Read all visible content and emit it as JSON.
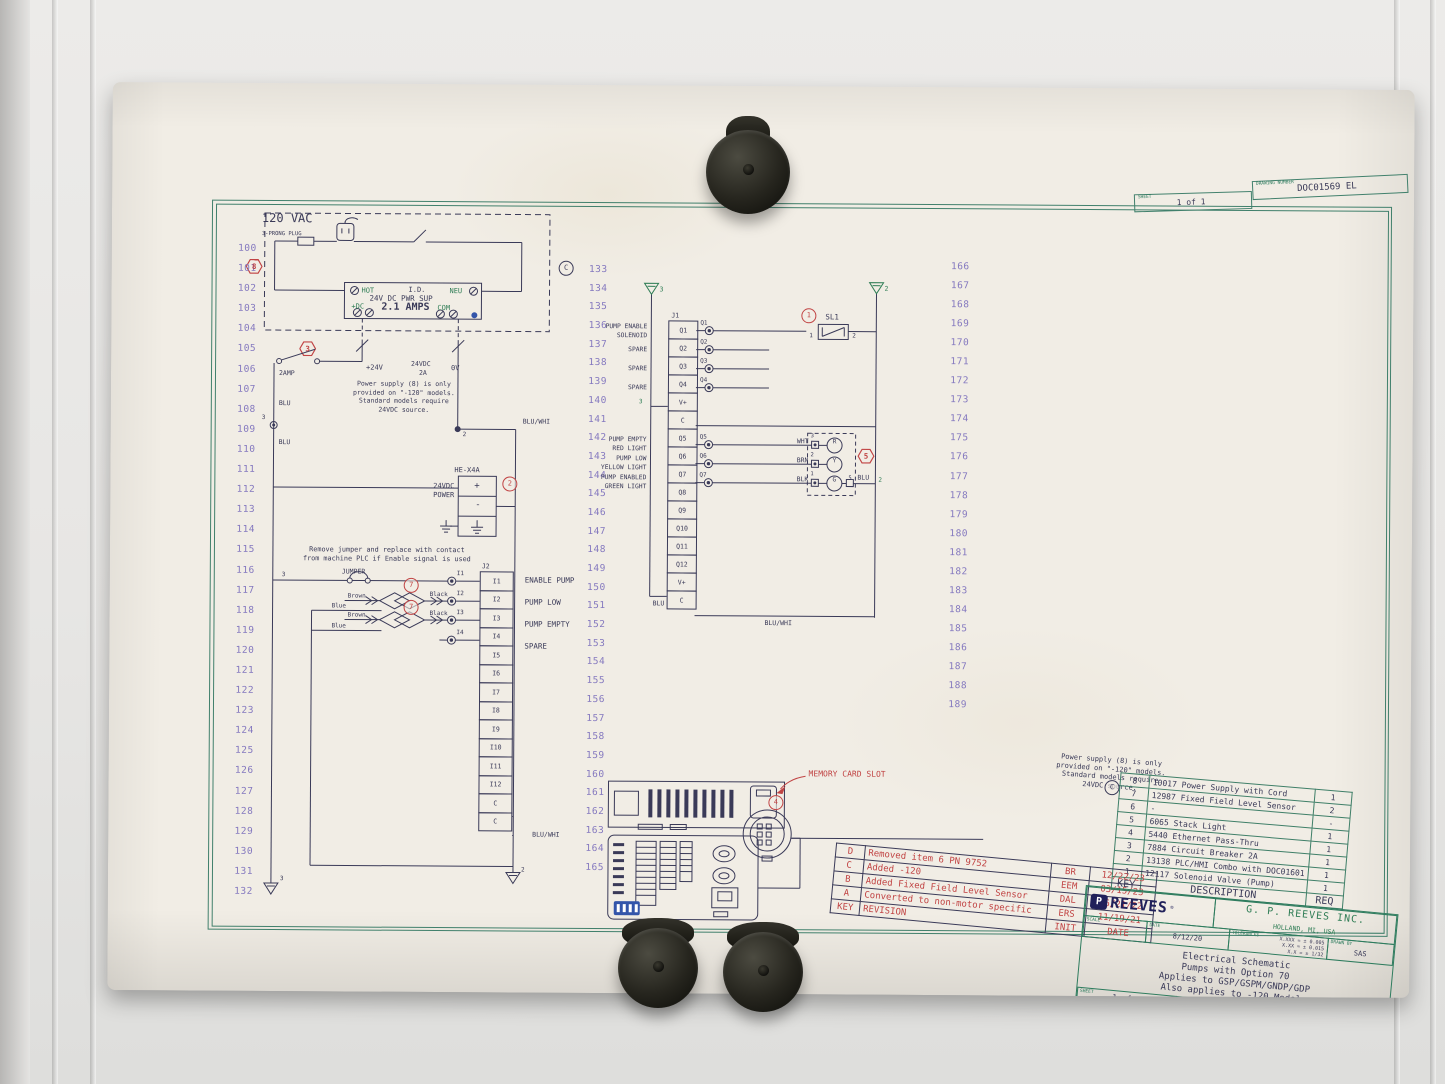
{
  "frame": {
    "sheet_label": "SHEET",
    "sheet_value": "1 of 1",
    "dwg_label": "DRAWING NUMBER",
    "dwg_value": "DOC01569 EL"
  },
  "wires": {
    "left": [
      "100",
      "101",
      "102",
      "103",
      "104",
      "105",
      "106",
      "107",
      "108",
      "109",
      "110",
      "111",
      "112",
      "113",
      "114",
      "115",
      "116",
      "117",
      "118",
      "119",
      "120",
      "121",
      "122",
      "123",
      "124",
      "125",
      "126",
      "127",
      "128",
      "129",
      "130",
      "131",
      "132"
    ],
    "middle": [
      "133",
      "134",
      "135",
      "136",
      "137",
      "138",
      "139",
      "140",
      "141",
      "142",
      "143",
      "144",
      "145",
      "146",
      "147",
      "148",
      "149",
      "150",
      "151",
      "152",
      "153",
      "154",
      "155",
      "156",
      "157",
      "158",
      "159",
      "160",
      "161",
      "162",
      "163",
      "164",
      "165"
    ],
    "right": [
      "166",
      "167",
      "168",
      "169",
      "170",
      "171",
      "172",
      "173",
      "174",
      "175",
      "176",
      "177",
      "178",
      "179",
      "180",
      "181",
      "182",
      "183",
      "184",
      "185",
      "186",
      "187",
      "188",
      "189"
    ]
  },
  "power": {
    "key": "8",
    "vac": "120 VAC",
    "plug": "3-PRONG PLUG",
    "hot": "HOT",
    "id_label": "I.D.",
    "neu": "NEU",
    "name": "24V DC PWR SUP",
    "plus_dc": "+DC",
    "amps": "2.1 AMPS",
    "com": "COM",
    "rev_marker": "C"
  },
  "breaker": {
    "key": "3",
    "amp": "2AMP",
    "plus24": "+24V",
    "vdc": "24VDC",
    "a2": "2A",
    "zero": "0V"
  },
  "left_rail": {
    "blu_top": "BLU",
    "node3": "3",
    "blu_bottom": "BLU",
    "gnd": "3"
  },
  "node2": {
    "num": "2",
    "bluwhi": "BLU/WHI"
  },
  "note_left": "Power supply (8) is only\nprovided on \"-120\" models.\nStandard models require\n24VDC source.",
  "note_right": "Power supply (8) is only\nprovided on \"-120\" models.\nStandard models require\n24VDC source.",
  "note_right_marker": "C",
  "hex4a": {
    "name": "HE-X4A",
    "key": "2",
    "power": "24VDC\nPOWER",
    "plus": "+",
    "minus": "-"
  },
  "jumper": {
    "note": "Remove jumper and replace with contact\nfrom machine PLC if Enable signal is used",
    "label": "JUMPER",
    "n3": "3"
  },
  "sensors": {
    "key1": "7",
    "key2": "7",
    "brown1": "Brown",
    "black1": "Black",
    "blue1": "Blue",
    "brown2": "Brown",
    "black2": "Black",
    "blue2": "Blue"
  },
  "j2": {
    "name": "J2",
    "cells": [
      "I1",
      "I2",
      "I3",
      "I4",
      "I5",
      "I6",
      "I7",
      "I8",
      "I9",
      "I10",
      "I11",
      "I12",
      "C",
      "C"
    ],
    "pins": [
      "I1",
      "I2",
      "I3",
      "I4"
    ],
    "signals": [
      "ENABLE PUMP",
      "PUMP LOW",
      "PUMP EMPTY",
      "SPARE"
    ],
    "bluwhi": "BLU/WHI",
    "gnd": "2"
  },
  "j1": {
    "name": "J1",
    "gnd_left": "3",
    "gnd_right": "2",
    "cells": [
      "Q1",
      "Q2",
      "Q3",
      "Q4",
      "V+",
      "C",
      "Q5",
      "Q6",
      "Q7",
      "Q8",
      "Q9",
      "Q10",
      "Q11",
      "Q12",
      "V+",
      "C"
    ],
    "pins_top": [
      "Q1",
      "Q2",
      "Q3",
      "Q4"
    ],
    "pins_bottom": [
      "Q5",
      "Q6",
      "Q7"
    ],
    "labels": [
      "PUMP ENABLE\nSOLENOID",
      "SPARE",
      "SPARE",
      "SPARE",
      "PUMP EMPTY\nRED LIGHT",
      "PUMP LOW\nYELLOW LIGHT",
      "PUMP ENABLED\nGREEN LIGHT"
    ],
    "v_num": "3",
    "blu": "BLU",
    "bluwhi": "BLU/WHI"
  },
  "sl1": {
    "key": "1",
    "name": "SL1",
    "t1": "1",
    "t2": "2"
  },
  "stack": {
    "key": "5",
    "rows": [
      {
        "wire": "WHT",
        "pin": "3",
        "lamp": "R"
      },
      {
        "wire": "BRN",
        "pin": "2",
        "lamp": "Y"
      },
      {
        "wire": "BLK",
        "pin": "1",
        "lamp": "G"
      }
    ],
    "pin5": "5",
    "blu": "BLU",
    "n2": "2"
  },
  "memory": {
    "label": "MEMORY CARD SLOT",
    "key": "4"
  },
  "rev_table": {
    "rows": [
      {
        "k": "D",
        "d": "Removed item 6 PN 9752",
        "i": "BR",
        "dt": "12/22/23"
      },
      {
        "k": "C",
        "d": "Added -120",
        "i": "EEM",
        "dt": "03/15/23"
      },
      {
        "k": "B",
        "d": "Added Fixed Field Level Sensor",
        "i": "DAL",
        "dt": "06/21/22"
      },
      {
        "k": "A",
        "d": "Converted to non-motor specific",
        "i": "ERS",
        "dt": "11/19/21"
      }
    ],
    "foot": {
      "k": "KEY",
      "d": "REVISION",
      "i": "INIT",
      "dt": "DATE"
    }
  },
  "bom": {
    "rows": [
      {
        "k": "8",
        "d": "10017 Power Supply with Cord",
        "q": "1"
      },
      {
        "k": "7",
        "d": "12987 Fixed Field Level Sensor",
        "q": "2"
      },
      {
        "k": "6",
        "d": "-",
        "q": "-"
      },
      {
        "k": "5",
        "d": "6065 Stack Light",
        "q": "1"
      },
      {
        "k": "4",
        "d": "5440 Ethernet Pass-Thru",
        "q": "1"
      },
      {
        "k": "3",
        "d": "7884 Circuit Breaker 2A",
        "q": "1"
      },
      {
        "k": "2",
        "d": "13138 PLC/HMI Combo with DOC01601",
        "q": "1"
      },
      {
        "k": "1",
        "d": "12117 Solenoid Valve (Pump)",
        "q": "1"
      }
    ],
    "foot": {
      "k": "KEY",
      "d": "DESCRIPTION",
      "q": "REQ"
    }
  },
  "title_block": {
    "logo": "REEVES",
    "logo_icon": "P",
    "reg": "®",
    "company": "G. P. REEVES INC.",
    "city": "HOLLAND, MI, USA",
    "scale_label": "SCALE",
    "scale": "-",
    "date_label": "DATE",
    "date": "8/12/20",
    "tol_label": "TOLERANCES",
    "tols": "X.XXX = ± 0.005\nX.XX = ± 0.015\nX.X = ± 1/32",
    "drawn_label": "DRAWN BY",
    "drawn": "SAS",
    "titles": "Electrical Schematic\nPumps with Option 70\nApplies to GSP/GSPM/GNDP/GDP\nAlso applies to -120 Models",
    "sheet_label": "SHEET",
    "sheet": "1 of 1",
    "dwg_label": "DRAWING NUMBER",
    "dwg": "DOC01569 EL"
  }
}
